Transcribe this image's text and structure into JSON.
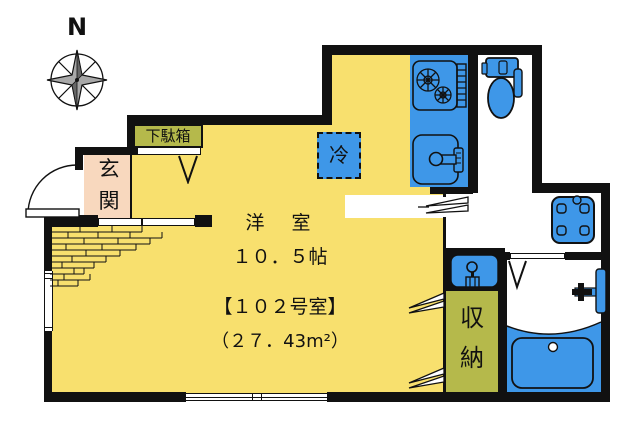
{
  "compass": {
    "label": "N"
  },
  "rooms": {
    "main": {
      "name": "洋　室",
      "size": "１０．５帖",
      "unit": "【１０２号室】",
      "area": "（２７．43m²）"
    },
    "entrance": {
      "chars": [
        "玄",
        "関"
      ]
    },
    "shoe_cabinet": {
      "label": "下駄箱"
    },
    "storage": {
      "chars": [
        "収",
        "納"
      ]
    },
    "refrigerator": {
      "label": "冷"
    }
  },
  "fixtures": [
    "compass-rose",
    "entrance-door",
    "shoe-cabinet-door",
    "step-bricks",
    "window-left",
    "window-bottom",
    "stove",
    "fish-grill",
    "kitchen-sink",
    "refrigerator-space",
    "toilet",
    "washing-machine",
    "washbasin",
    "storage-doors",
    "washroom-door",
    "bathroom-door",
    "bathtub",
    "bath-faucet"
  ],
  "colors": {
    "wall": "#111111",
    "room_yellow": "#F8E06E",
    "entrance_pink": "#F8D8BE",
    "cabinet_olive": "#B5B94B",
    "fixture_blue": "#3E97E8",
    "background": "#FFFFFF"
  }
}
